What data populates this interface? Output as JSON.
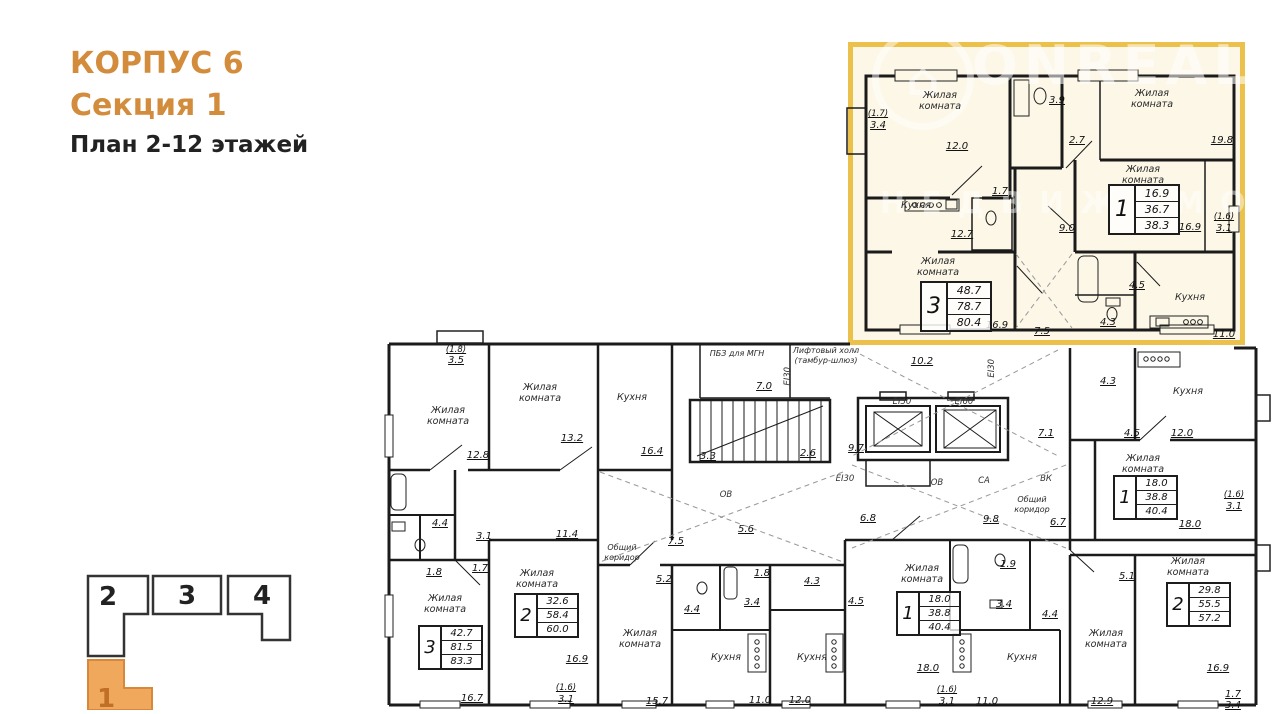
{
  "header": {
    "building": "КОРПУС 6",
    "section": "Секция 1",
    "floors": "План 2-12 этажей",
    "accent_color": "#d28c3c"
  },
  "watermark": {
    "brand": "ONREALT",
    "tagline": "НЕДВИЖИМОСТИ"
  },
  "rooms": {
    "living": "Жилая комната",
    "kitchen": "Кухня",
    "corridor": "Общий коридор",
    "elevator_hall": "Лифтовый холл (тамбур-шлюз)",
    "safe_zone": "ПБЗ для МГН"
  },
  "eng": {
    "ei30": "EI30",
    "ei60": "EI60",
    "ov": "ОВ",
    "vk": "ВК",
    "sa": "СА"
  },
  "fragment": {
    "border_color": "#ecc14b",
    "fill_color": "#fcf7e7",
    "apt3": {
      "rooms": "3",
      "areas": [
        "48.7",
        "78.7",
        "80.4"
      ],
      "dims": {
        "balcony_k": "(1.7)",
        "balcony": "3.4",
        "living1": "12.0",
        "wc": "3.9",
        "hall_top": "2.7",
        "living2": "19.8",
        "kitchen": "12.7",
        "bath": "1.7",
        "hall": "9.0",
        "living3": "16.9",
        "corridor": "7.5"
      }
    },
    "apt1": {
      "rooms": "1",
      "areas": [
        "16.9",
        "36.7",
        "38.3"
      ],
      "dims": {
        "living": "16.9",
        "balcony_k": "(1.6)",
        "balcony": "3.1",
        "hall": "4.5",
        "bath": "4.3",
        "kitchen": "11.0"
      }
    }
  },
  "plan": {
    "tables": [
      {
        "rooms": "3",
        "areas": [
          "42.7",
          "81.5",
          "83.3"
        ]
      },
      {
        "rooms": "2",
        "areas": [
          "32.6",
          "58.4",
          "60.0"
        ]
      },
      {
        "rooms": "1",
        "areas": [
          "18.0",
          "38.8",
          "40.4"
        ]
      },
      {
        "rooms": "1",
        "areas": [
          "18.0",
          "38.8",
          "40.4"
        ]
      },
      {
        "rooms": "2",
        "areas": [
          "29.8",
          "55.5",
          "57.2"
        ]
      }
    ],
    "dims": {
      "tl_balcony_k": "(1.8)",
      "tl_balcony": "3.5",
      "living_a": "12.8",
      "living_b": "13.2",
      "kitchen_a": "16.4",
      "bath_a": "4.4",
      "wc_a": "1.8",
      "hall_a": "1.7",
      "corr_a": "3.1",
      "corr_b": "11.4",
      "living_c_w": "16.7",
      "living_d_w": "16.9",
      "bal_d_k": "(1.6)",
      "bal_d": "3.1",
      "stair_a": "3.3",
      "stair_b": "2.6",
      "mgn": "7.0",
      "core_a": "10.2",
      "core_b": "9.7",
      "core_c": "7.1",
      "corr_c": "7.5",
      "corr_d": "5.6",
      "corr_e": "6.8",
      "corr_f": "9.8",
      "corr_g": "6.7",
      "hall_b": "5.2",
      "hall_c": "4.4",
      "living_e_w": "15.7",
      "wc_b": "1.8",
      "bath_b": "3.4",
      "bath_c": "4.3",
      "kitchen_b": "11.0",
      "kitchen_c": "12.0",
      "wc_c": "1.9",
      "bath_d": "3.4",
      "hall_d": "4.5",
      "hall_e": "4.4",
      "kitchen_d": "11.0",
      "living_f_w": "18.0",
      "bal_f_k": "(1.6)",
      "bal_f": "3.1",
      "rt_bath": "4.3",
      "rt_hall": "4.5",
      "rt_kitchen": "12.0",
      "rt_living_w": "18.0",
      "rt_bal_k": "(1.6)",
      "rt_bal": "3.1",
      "br_hall": "5.1",
      "br_living": "12.9",
      "br_living_w": "16.9",
      "br_bal_k": "1.7",
      "br_bal": "3.4"
    }
  },
  "section_nav": {
    "items": [
      "2",
      "3",
      "4"
    ],
    "active_label": "1",
    "active_fill": "#efa85c"
  }
}
